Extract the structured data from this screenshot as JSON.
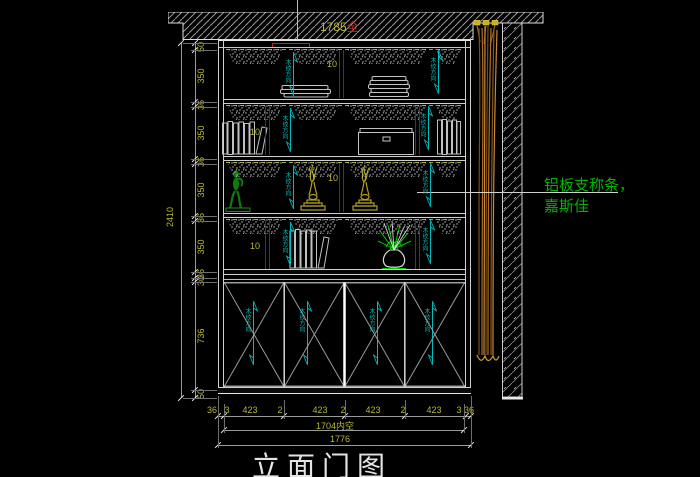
{
  "drawing": {
    "title": "立面门图",
    "top_dim": "1785",
    "top_dim_suffix": "全"
  },
  "dimensions": {
    "overall_height": "2410",
    "left_chain": [
      "50",
      "350",
      "36",
      "350",
      "36",
      "350",
      "36",
      "350",
      "36",
      "30",
      "736",
      "50"
    ],
    "bottom_chain": [
      "36",
      "3",
      "423",
      "2",
      "423",
      "2",
      "423",
      "2",
      "423",
      "3",
      "36"
    ],
    "inner_width": "1704内空",
    "overall_width": "1776"
  },
  "annotations": {
    "grain_direction": "木纹方向",
    "shelf_divider_thickness": "10",
    "material_note": [
      "铝板支称条，",
      "嘉斯佳"
    ]
  },
  "colors": {
    "background": "#000000",
    "line": "#c8c8c8",
    "dim_text": "#b8b832",
    "grain_text": "#00bcbc",
    "divider_blue": "#2626e0",
    "highlight_red": "#bb2222",
    "note_green": "#00b400",
    "curtain": "#b06f28"
  }
}
